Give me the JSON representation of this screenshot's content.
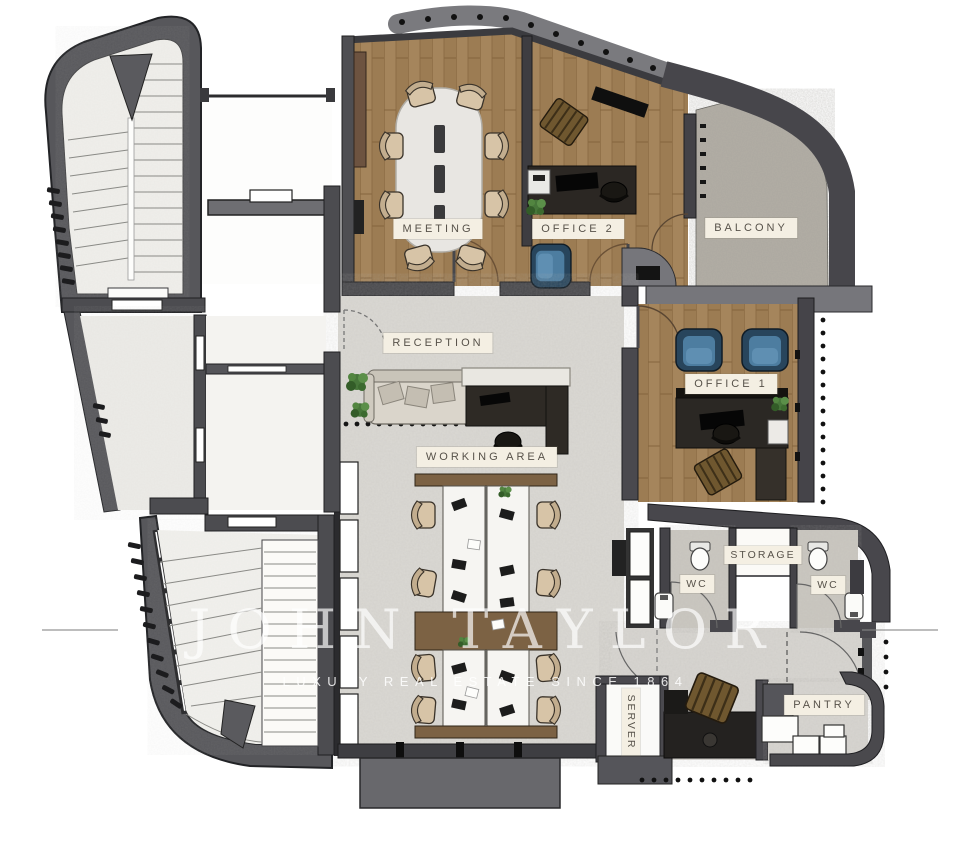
{
  "plan": {
    "type": "office-floor-plan",
    "watermark": {
      "brand": "JOHN TAYLOR",
      "tagline": "LUXURY REAL ESTATE SINCE 1864"
    },
    "rooms": [
      {
        "id": "meeting",
        "label": "MEETING",
        "finish": "wood"
      },
      {
        "id": "office2",
        "label": "OFFICE 2",
        "finish": "wood"
      },
      {
        "id": "balcony",
        "label": "BALCONY",
        "finish": "concrete"
      },
      {
        "id": "reception",
        "label": "RECEPTION",
        "finish": "screed"
      },
      {
        "id": "office1",
        "label": "OFFICE 1",
        "finish": "wood"
      },
      {
        "id": "working-area",
        "label": "WORKING AREA",
        "finish": "screed"
      },
      {
        "id": "storage",
        "label": "STORAGE",
        "finish": "screed"
      },
      {
        "id": "wc-left",
        "label": "WC",
        "finish": "terrazzo"
      },
      {
        "id": "wc-right",
        "label": "WC",
        "finish": "terrazzo"
      },
      {
        "id": "server",
        "label": "SERVER",
        "finish": "screed"
      },
      {
        "id": "pantry",
        "label": "PANTRY",
        "finish": "screed"
      }
    ],
    "palette": {
      "wall": "#525256",
      "wall_light": "#7a7a7e",
      "wood_floor": "#a5855c",
      "screed_floor": "#dbd9d4",
      "balcony_floor": "#b2aea5",
      "label_bg": "#f4efe3",
      "label_text": "#57524a",
      "accent_blue": "#4d7da0",
      "plant_green": "#47763a"
    }
  }
}
